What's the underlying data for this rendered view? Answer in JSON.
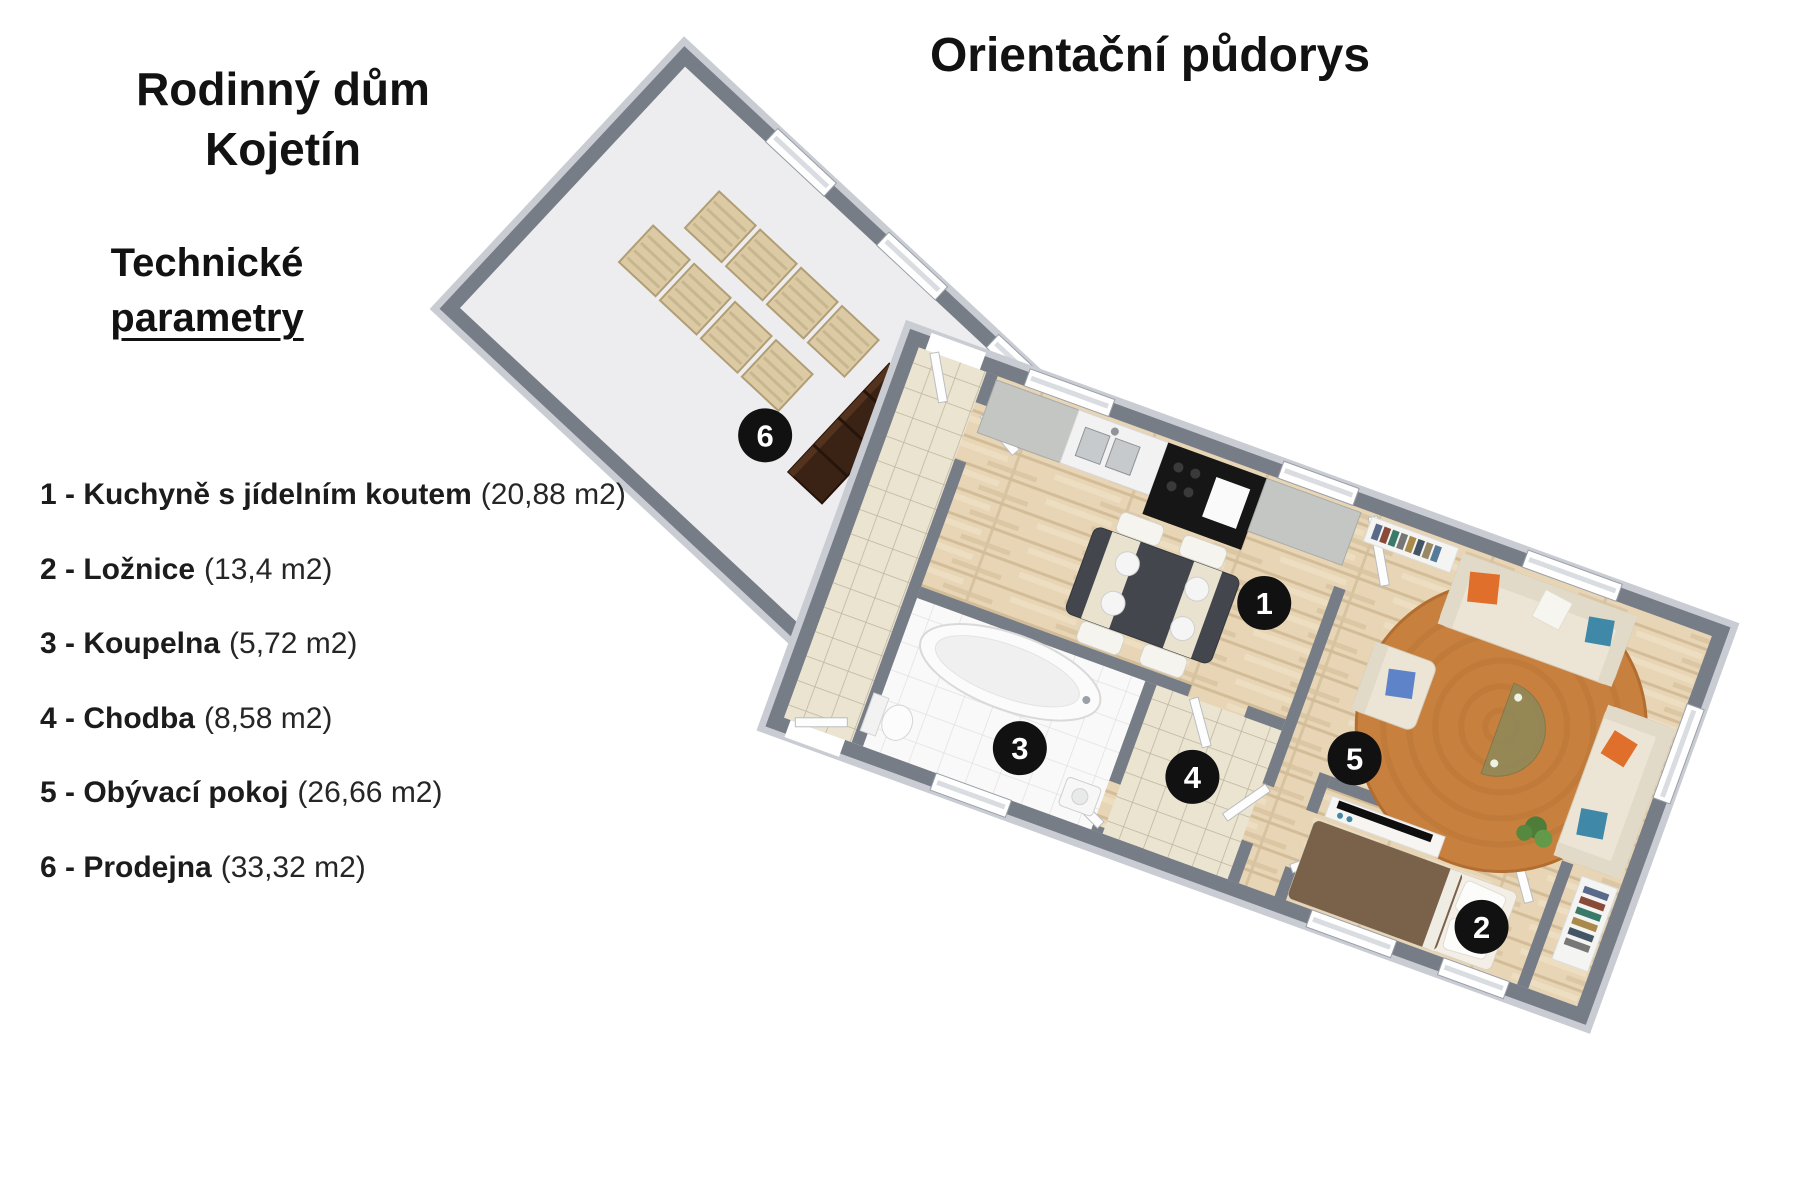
{
  "header": {
    "plan_title": "Orientační půdorys"
  },
  "brand": {
    "line1": "Rodinný dům",
    "line2": "Kojetín"
  },
  "tech": {
    "line1": "Technické",
    "line2": "parametry"
  },
  "rooms": [
    {
      "num": "1",
      "label": "1 - Kuchyně s jídelním koutem",
      "area": "(20,88 m2)"
    },
    {
      "num": "2",
      "label": "2 - Ložnice",
      "area": "(13,4 m2)"
    },
    {
      "num": "3",
      "label": "3 - Koupelna",
      "area": "(5,72 m2)"
    },
    {
      "num": "4",
      "label": "4 - Chodba",
      "area": "(8,58 m2)"
    },
    {
      "num": "5",
      "label": "5 - Obývací pokoj",
      "area": "(26,66 m2)"
    },
    {
      "num": "6",
      "label": "6 - Prodejna",
      "area": "(33,32 m2)"
    }
  ],
  "colors": {
    "wall": "#767d87",
    "wall_edge": "#c9cdd3",
    "wood_floor": "#e7d5b5",
    "beige_tile": "#ebe4d1",
    "white_tile": "#f9f9f9",
    "prodejna_floor": "#ededef",
    "rug": "#c8803e",
    "sofa": "#ece5d6",
    "pillow_orange": "#e06f2b",
    "pillow_teal": "#3f88a8",
    "pillow_blue": "#5e83c8",
    "bed_duvet": "#79614a",
    "cabinet_dark": "#3a2315",
    "crate": "#dccaa5",
    "badge": "#111111"
  }
}
